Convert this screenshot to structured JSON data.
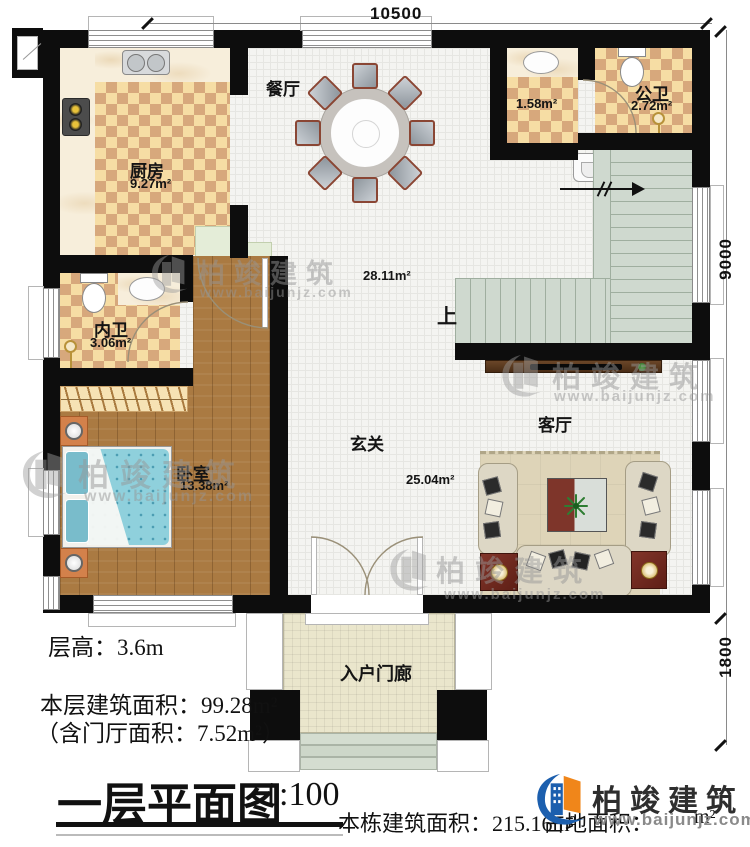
{
  "dimensions": {
    "top": "10500",
    "right_upper": "9000",
    "right_lower": "1800"
  },
  "rooms": {
    "kitchen": {
      "name": "厨房",
      "area": "9.27m²"
    },
    "dining": {
      "name": "餐厅"
    },
    "wash": {
      "area": "1.58m²"
    },
    "public_bath": {
      "name": "公卫",
      "area": "2.72m²"
    },
    "private_bath": {
      "name": "内卫",
      "area": "3.06m²"
    },
    "bedroom": {
      "name": "卧室",
      "area": "13.38m²"
    },
    "foyer": {
      "name": "玄关",
      "area": "25.04m²"
    },
    "living": {
      "name": "客厅"
    },
    "hall": {
      "area": "28.11m²"
    },
    "porch": {
      "name": "入户门廊"
    },
    "stairs": {
      "up_label": "上"
    }
  },
  "title_block": {
    "floor_height": "层高：3.6m",
    "floor_area": "本层建筑面积：99.28m²",
    "foyer_area_note": "（含门厅面积：7.52m²）",
    "title": "一层平面图",
    "scale": "1:100",
    "building_area": "本栋建筑面积：215.16m²",
    "site_area_label": "占地面积：",
    "site_area_unit": "m²"
  },
  "watermark": {
    "brand": "柏竣建筑",
    "url": "www.baijunjz.com"
  },
  "logo": {
    "brand": "柏竣建筑",
    "url": "www.baijunjz.com"
  },
  "colors": {
    "wall": "#0d0d0d",
    "checker_light": "#f6dda4",
    "checker_dark": "#d7a87c",
    "wood": "#aa7a42",
    "stair": "#cfd9cf",
    "accent_blue": "#1c5fae",
    "accent_orange": "#f0861a"
  }
}
